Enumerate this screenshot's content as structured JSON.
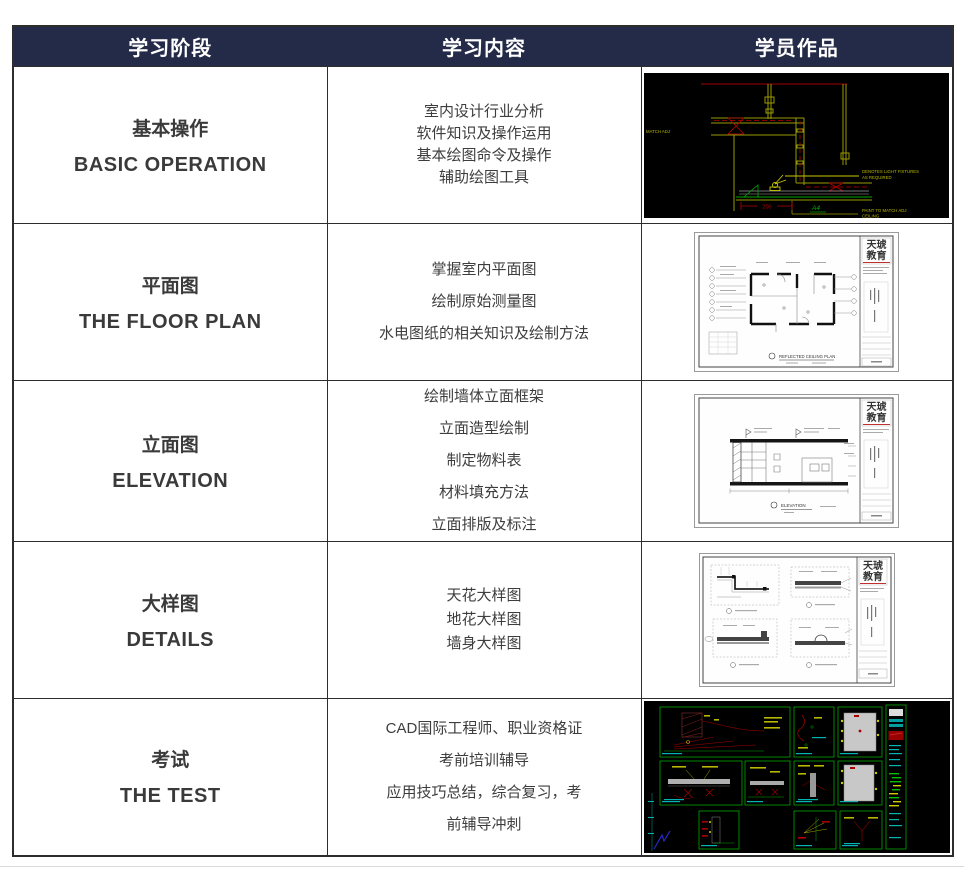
{
  "colors": {
    "header_bg": "#242b48",
    "header_text": "#ffffff",
    "body_text": "#3d3d3d",
    "border": "#2d2d2d",
    "cad_black": "#000000",
    "cad_yellow": "#b8b800",
    "cad_red": "#b40000",
    "cad_green": "#00a800",
    "cad_cyan": "#00b4b4"
  },
  "table": {
    "header": {
      "columns": [
        "学习阶段",
        "学习内容",
        "学员作品"
      ]
    },
    "rows": [
      {
        "stage_zh": "基本操作",
        "stage_en": "BASIC OPERATION",
        "content_lines": [
          "室内设计行业分析",
          "软件知识及操作运用",
          "基本绘图命令及操作",
          "辅助绘图工具"
        ],
        "artwork": "cad-ceiling-detail-dark"
      },
      {
        "stage_zh": "平面图",
        "stage_en": "THE FLOOR PLAN",
        "content_lines": [
          "掌握室内平面图",
          "绘制原始测量图",
          "水电图纸的相关知识及绘制方法"
        ],
        "artwork": "floor-plan-sheet"
      },
      {
        "stage_zh": "立面图",
        "stage_en": "ELEVATION",
        "content_lines": [
          "绘制墙体立面框架",
          "立面造型绘制",
          "制定物料表",
          "材料填充方法",
          "立面排版及标注"
        ],
        "artwork": "elevation-sheet"
      },
      {
        "stage_zh": "大样图",
        "stage_en": "DETAILS",
        "content_lines": [
          "天花大样图",
          "地花大样图",
          "墙身大样图"
        ],
        "artwork": "details-sheet"
      },
      {
        "stage_zh": "考试",
        "stage_en": "THE TEST",
        "content_lines": [
          "CAD国际工程师、职业资格证",
          "考前培训辅导",
          "应用技巧总结，综合复习，考",
          "前辅导冲刺"
        ],
        "artwork": "cad-exam-sheet-dark"
      }
    ]
  },
  "artworks": {
    "ceiling": {
      "note_left": "MATCH ADJ",
      "note_fixtures_1": "DENOTES LIGHT FIXTURES",
      "note_fixtures_2": "AS REQUIRED",
      "note_paint_1": "PAINT TO MATCH ADJ",
      "note_paint_2": "CEILING",
      "dim": "200",
      "tag": "A4"
    },
    "floor_plan": {
      "logo_line1": "天琥",
      "logo_line2": "教育",
      "caption": "REFLECTED CEILING PLAN"
    },
    "elevation": {
      "logo_line1": "天琥",
      "logo_line2": "教育",
      "caption": "ELEVATION"
    },
    "details": {
      "logo_line1": "天琥",
      "logo_line2": "教育"
    }
  }
}
